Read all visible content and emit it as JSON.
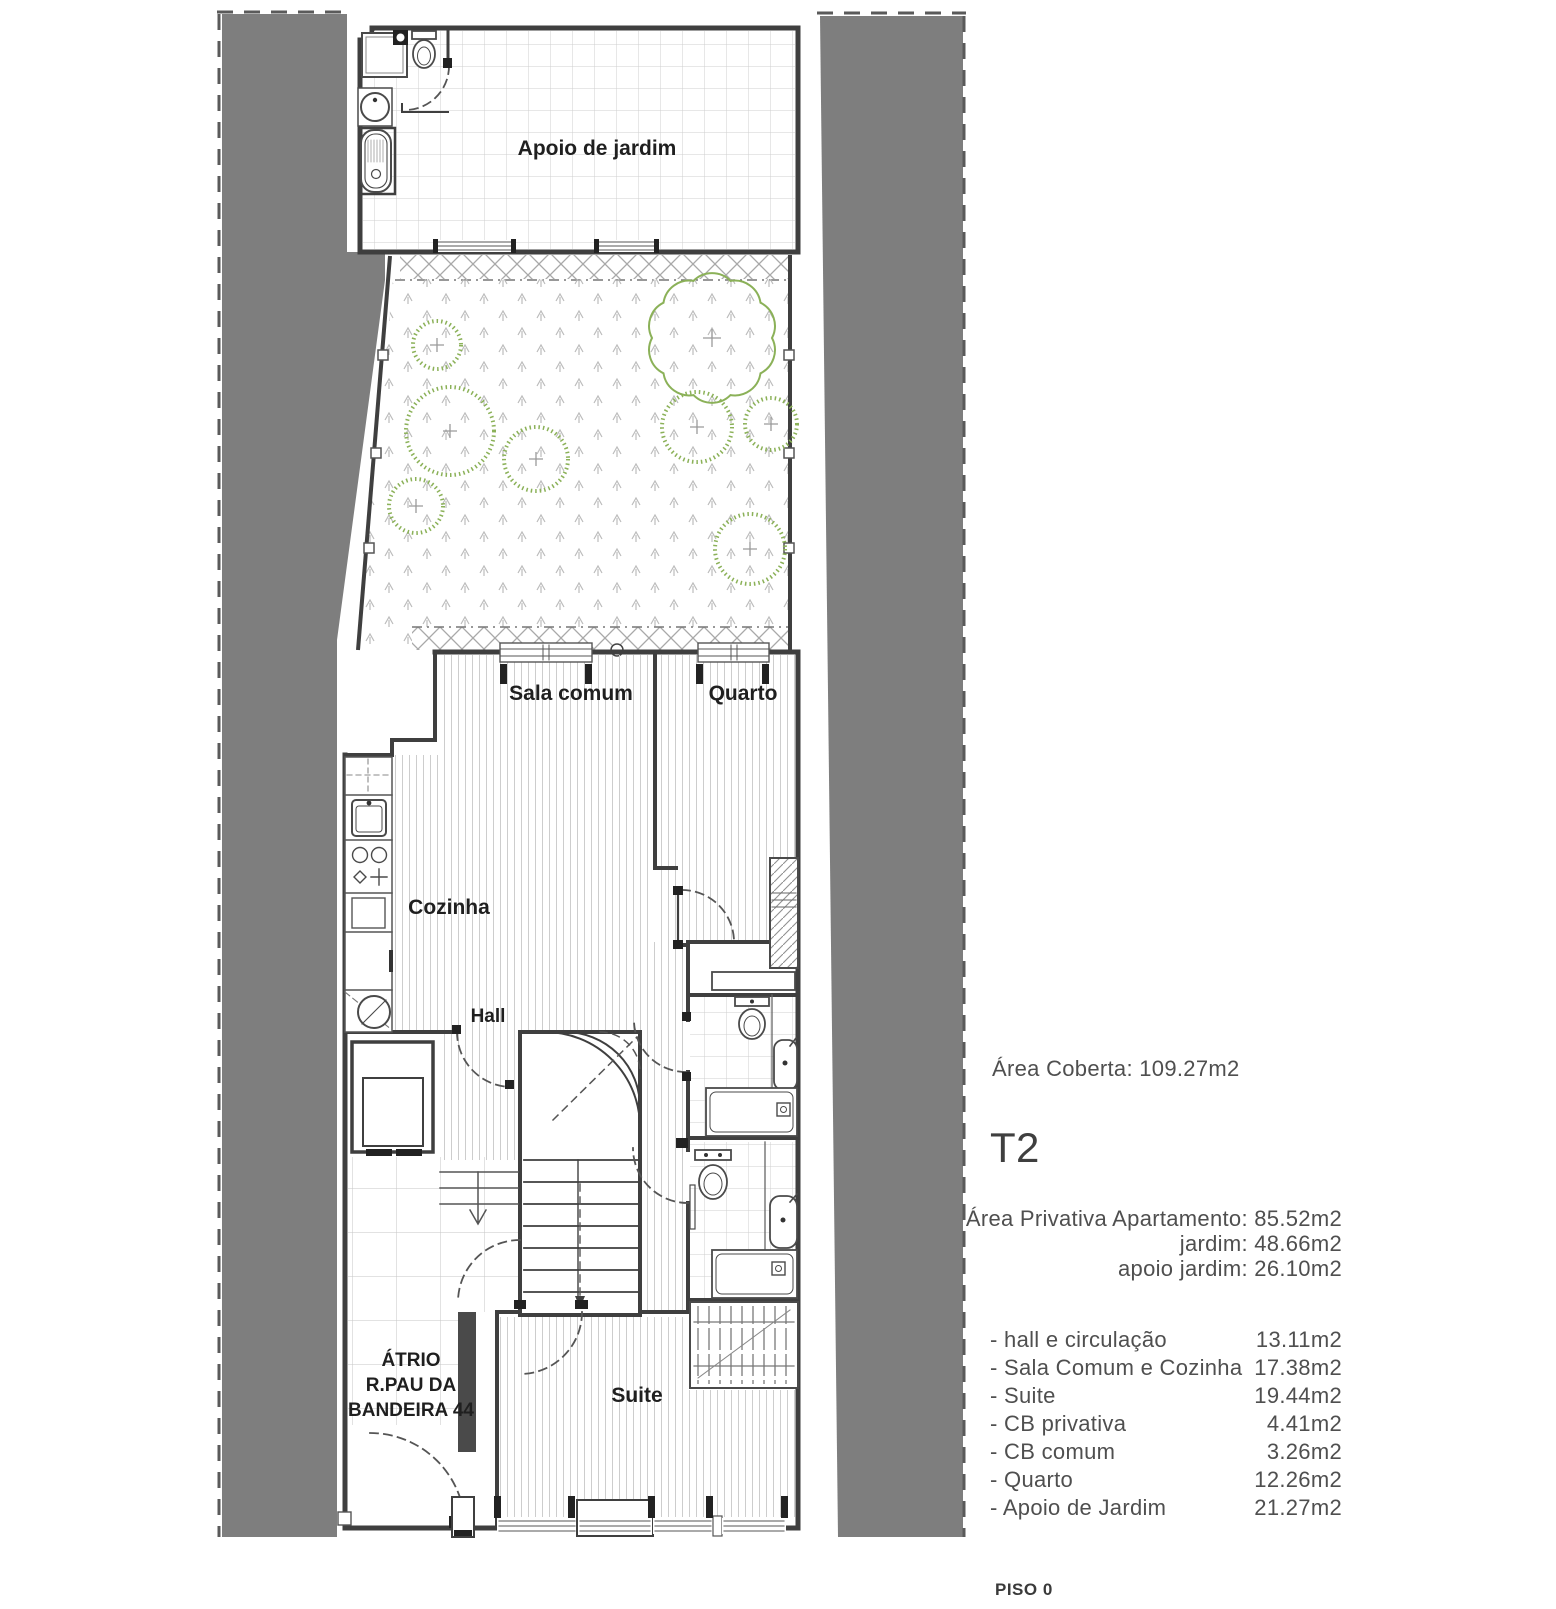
{
  "plan": {
    "labels": {
      "apoio_jardim": "Apoio de jardim",
      "sala_comum": "Sala comum",
      "quarto": "Quarto",
      "cozinha": "Cozinha",
      "hall": "Hall",
      "suite": "Suite",
      "atrio_line1": "ÁTRIO",
      "atrio_line2": "R.PAU DA",
      "atrio_line3": "BANDEIRA 44"
    }
  },
  "panel": {
    "area_coberta": "Área Coberta: 109.27m2",
    "unit_type": "T2",
    "private_area_line1": "Área Privativa Apartamento: 85.52m2",
    "private_area_line2": "jardim: 48.66m2",
    "private_area_line3": "apoio jardim:  26.10m2",
    "room_list": [
      {
        "label": "- hall e circulação",
        "area": "13.11m2"
      },
      {
        "label": "- Sala Comum e Cozinha",
        "area": "17.38m2"
      },
      {
        "label": "- Suite",
        "area": "19.44m2"
      },
      {
        "label": "- CB privativa",
        "area": "4.41m2"
      },
      {
        "label": "- CB comum",
        "area": "3.26m2"
      },
      {
        "label": "- Quarto",
        "area": "12.26m2"
      },
      {
        "label": "- Apoio de Jardim",
        "area": "21.27m2"
      }
    ],
    "floor_label": "PISO 0"
  },
  "colors": {
    "neighbor_fill": "#7e7e7e",
    "wall": "#3f3f3f",
    "vegetation": "#8bb158",
    "panel_text": "#4f4f4f"
  }
}
